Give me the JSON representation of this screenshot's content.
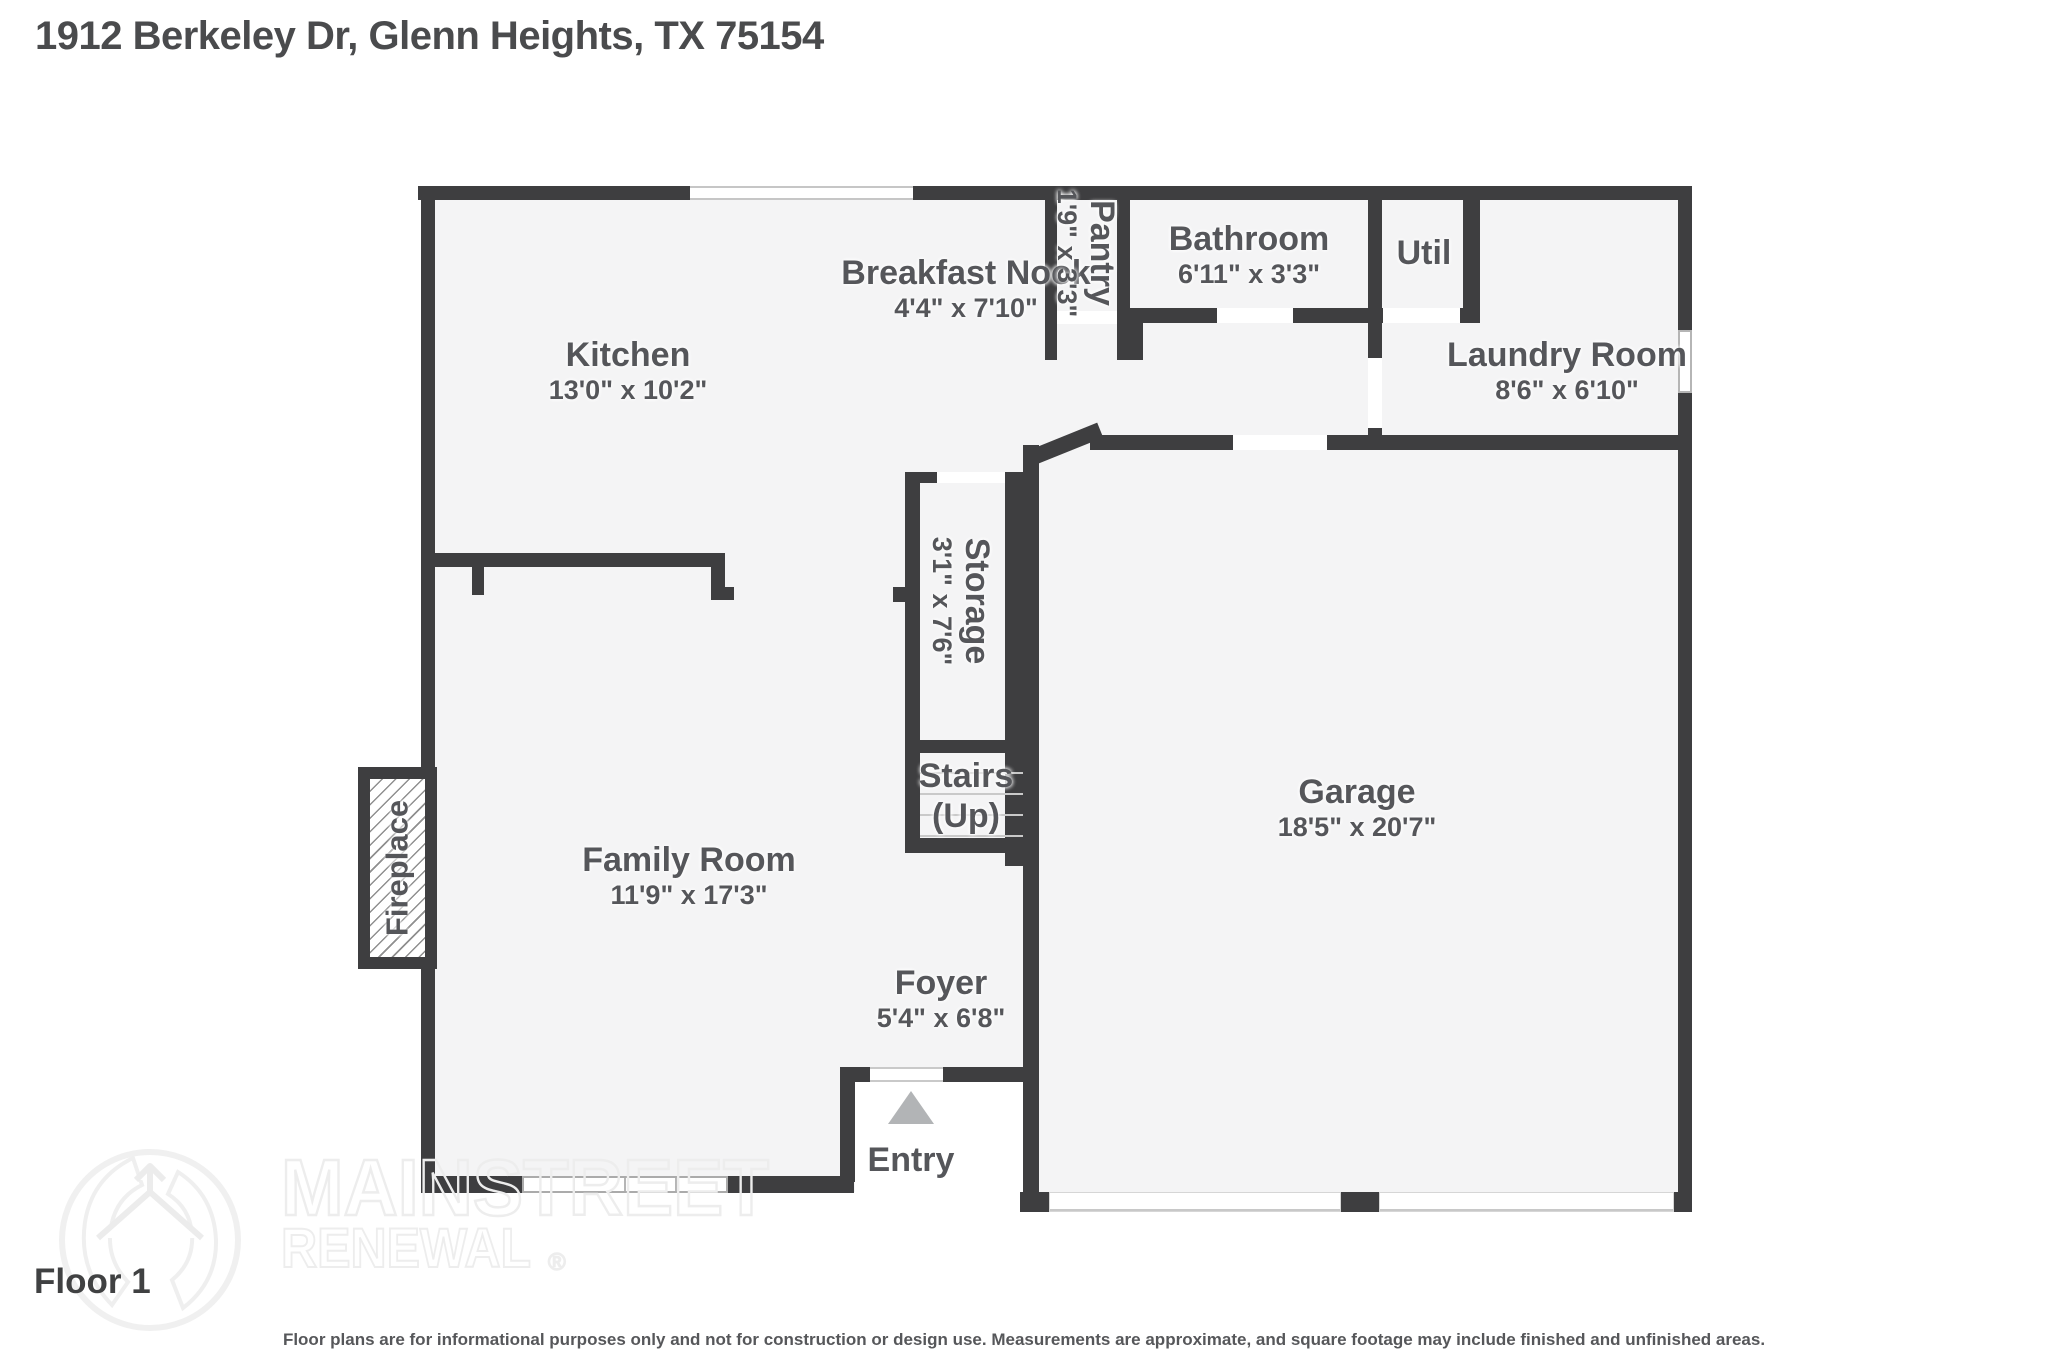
{
  "title": "1912 Berkeley Dr, Glenn Heights, TX 75154",
  "floor_label": "Floor 1",
  "rooms": {
    "kitchen": {
      "name": "Kitchen",
      "dims": "13'0\" x 10'2\""
    },
    "breakfast_nook": {
      "name": "Breakfast Nook",
      "dims": "4'4\" x 7'10\""
    },
    "pantry": {
      "name": "Pantry",
      "dims": "1'9\" x 3'3\""
    },
    "bathroom": {
      "name": "Bathroom",
      "dims": "6'11\" x 3'3\""
    },
    "util": {
      "name": "Util"
    },
    "laundry": {
      "name": "Laundry Room",
      "dims": "8'6\" x 6'10\""
    },
    "storage": {
      "name": "Storage",
      "dims": "3'1\" x 7'6\""
    },
    "stairs": {
      "name": "Stairs",
      "direction": "(Up)"
    },
    "family_room": {
      "name": "Family Room",
      "dims": "11'9\" x 17'3\""
    },
    "garage": {
      "name": "Garage",
      "dims": "18'5\" x 20'7\""
    },
    "foyer": {
      "name": "Foyer",
      "dims": "5'4\" x 6'8\""
    },
    "fireplace": {
      "name": "Fireplace"
    },
    "entry": {
      "name": "Entry"
    }
  },
  "watermark": {
    "line1": "MAINSTREET",
    "line2": "RENEWAL",
    "reg": "®"
  },
  "disclaimer": "Floor plans are for informational purposes only and not for construction or design use. Measurements are approximate, and square footage may include finished and unfinished areas.",
  "colors": {
    "wall": "#3e3e40",
    "floor": "#f4f4f5",
    "label_text": "#55565a",
    "watermark": "#ededed",
    "entry_arrow": "#b2b4b6"
  }
}
